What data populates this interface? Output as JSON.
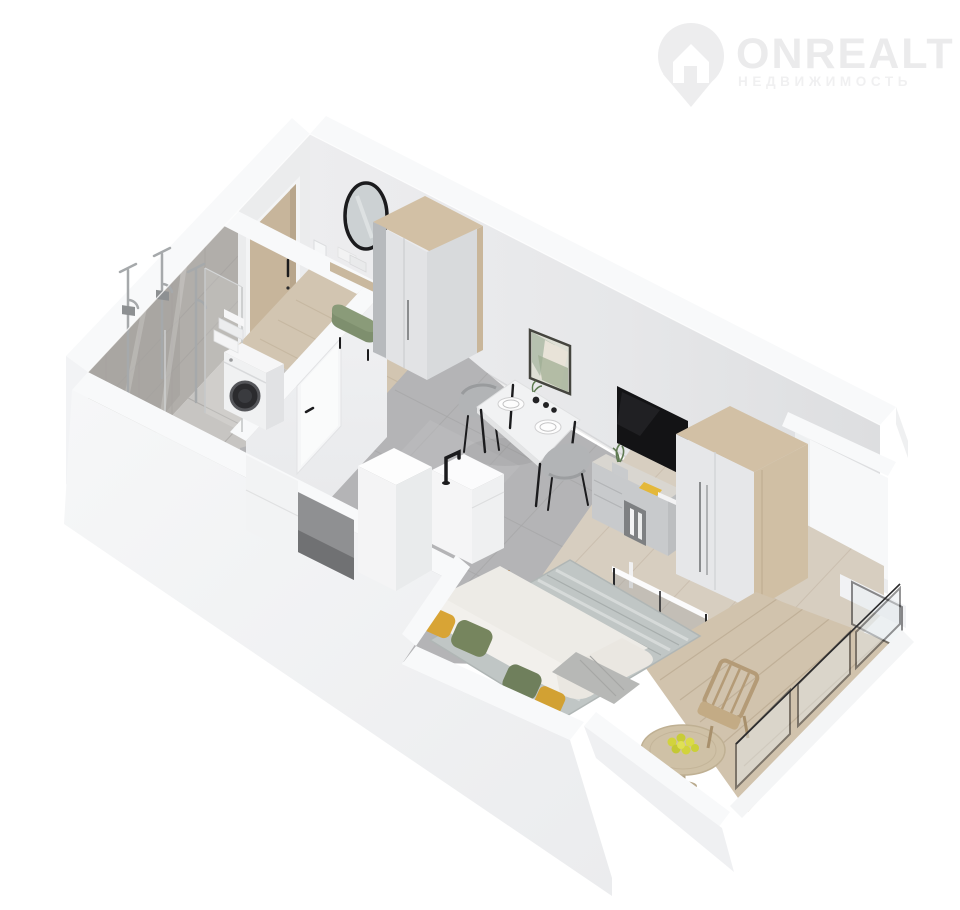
{
  "watermark": {
    "brand": "ONREALT",
    "subtitle": "НЕДВИЖИМОСТЬ",
    "icon": "location-pin-house-icon"
  },
  "scene": {
    "kind": "3d-floorplan-cutaway-render",
    "view": "isometric-from-above",
    "background": "#ffffff"
  },
  "rooms": [
    {
      "name": "bathroom",
      "items": [
        "tiled-walls",
        "shower-columns",
        "shower-glass",
        "washing-machine",
        "towel-stack",
        "bathroom-door"
      ]
    },
    {
      "name": "hallway",
      "items": [
        "entrance-door",
        "light-switch",
        "round-mirror",
        "console-shelf",
        "decor-boxes",
        "green-ottoman",
        "wardrobe"
      ]
    },
    {
      "name": "kitchen-living-room",
      "items": [
        "kitchen-column",
        "kitchen-counter",
        "black-faucet",
        "base-cabinet",
        "dining-table",
        "dining-chairs",
        "plates",
        "cups",
        "wall-art",
        "tv",
        "tv-stand",
        "potted-plant",
        "books",
        "wardrobe",
        "sofa",
        "pillows",
        "throw-blanket",
        "rug",
        "nesting-coffee-tables",
        "vase-with-dried-stems",
        "window-niche"
      ]
    },
    {
      "name": "balcony",
      "items": [
        "wood-deck",
        "round-table",
        "fruit-bowl",
        "folding-chair",
        "glass-railing",
        "balcony-window"
      ]
    }
  ],
  "palette": {
    "bg": "#ffffff",
    "wm-icon": "#ededee",
    "wm-text": "#ebebec",
    "wm-sub": "#f0f0f1",
    "wall-top": "#f8f9fa",
    "wall-outer": "#f2f3f5",
    "wall-inner": "#e9eaec",
    "wall-inner-dark": "#dfe0e2",
    "tile-wall": "#b1aeaa",
    "tile-line": "#a5a3a0",
    "bath-floor": "#c7c5c2",
    "kitchen-tile": "#b4b4b6",
    "hall-wood": "#d2c5b1",
    "living-wood": "#d7cec0",
    "balcony-wood": "#d1c3ad",
    "rug": "#c0c6c5",
    "wardrobe-wood": "#d2c0a5",
    "door-wood": "#c7b59b",
    "furn-white": "#f1f2f3",
    "stand-gray": "#c8cacc",
    "chair-gray": "#b2b4b6",
    "sofa-white": "#edebe6",
    "pillow-green": "#76855e",
    "ottoman-green": "#7e8f6e",
    "pillow-mustard": "#d8a435",
    "black": "#1b1b1d",
    "tv-black": "#131315",
    "chrome": "#a6a9ab",
    "fruit-yellow": "#d2d33c"
  }
}
